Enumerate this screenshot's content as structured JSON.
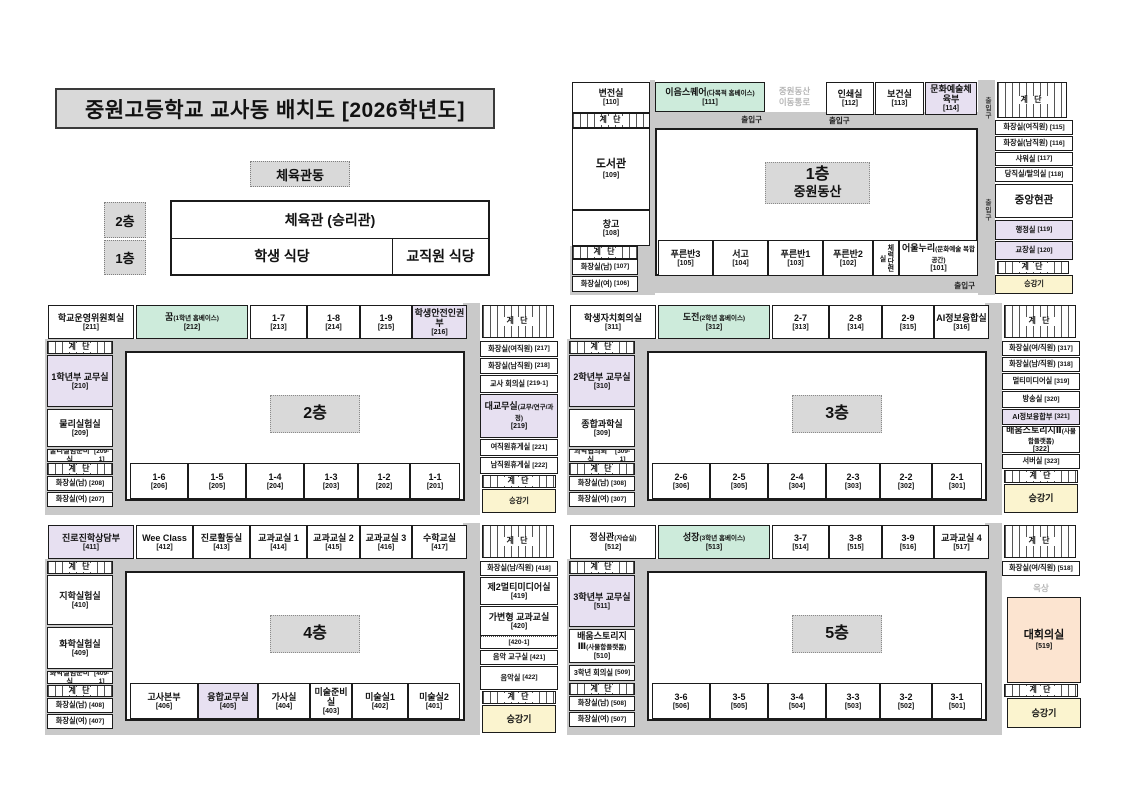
{
  "title": "중원고등학교 교사동 배치도 [2026학년도]",
  "colors": {
    "mint": "#cdebdb",
    "purple": "#e7e0f1",
    "peach": "#fce4d0",
    "elevator_yellow": "#fbf4cf",
    "corridor_gray": "#c9c9c9",
    "box_gray": "#d9d9d9"
  },
  "gym": {
    "building_label": "체육관동",
    "floor2_label": "2층",
    "floor1_label": "1층",
    "gym_name": "체육관 (승리관)",
    "student_cafeteria": "학생 식당",
    "staff_cafeteria": "교직원 식당"
  },
  "floors": {
    "f1": {
      "rooms": [
        {
          "id": "110",
          "label": "변전실",
          "num": "[110]"
        },
        {
          "id": "s1",
          "style": "stairs",
          "label": "계 단"
        },
        {
          "id": "109",
          "label": "도서관",
          "num": "[109]"
        },
        {
          "id": "108",
          "label": "창고",
          "num": "[108]"
        },
        {
          "id": "s2",
          "style": "stairs",
          "label": "계 단"
        },
        {
          "id": "107",
          "label": "화장실(남)",
          "num": "[107]"
        },
        {
          "id": "106",
          "label": "화장실(여)",
          "num": "[106]"
        },
        {
          "id": "111",
          "style": "mint",
          "label": "이음스퀘어",
          "sub": "(다목적 홈베이스)",
          "num": "[111]"
        },
        {
          "id": "exit1",
          "style": "cl",
          "label": "출입구",
          "align": "right"
        },
        {
          "id": "gtext",
          "style": "gtext",
          "label": "중원동산\n이동통로"
        },
        {
          "id": "112",
          "label": "인쇄실",
          "num": "[112]"
        },
        {
          "id": "113",
          "label": "보건실",
          "num": "[113]"
        },
        {
          "id": "114",
          "style": "purple",
          "label": "문화예술체육부",
          "num": "[114]"
        },
        {
          "id": "exit2",
          "style": "cl",
          "label": "출입구",
          "align": "left"
        },
        {
          "id": "s3",
          "style": "stairs",
          "label": "계 단"
        },
        {
          "id": "115",
          "label": "화장실(여직원)",
          "num": "[115]"
        },
        {
          "id": "116",
          "label": "화장실(남직원)",
          "num": "[116]"
        },
        {
          "id": "117",
          "label": "샤워실",
          "num": "[117]"
        },
        {
          "id": "118",
          "label": "당직실/탈의실",
          "num": "[118]"
        },
        {
          "id": "foyer",
          "label": "중앙현관"
        },
        {
          "id": "119",
          "style": "purple",
          "label": "행정실",
          "num": "[119]"
        },
        {
          "id": "120",
          "style": "purple",
          "label": "교장실",
          "num": "[120]"
        },
        {
          "id": "s4",
          "style": "stairs",
          "label": "계 단"
        },
        {
          "id": "lift",
          "style": "lift",
          "label": "승강기"
        },
        {
          "id": "vexit1",
          "style": "vcl",
          "label": "출입구"
        },
        {
          "id": "vexit2",
          "style": "vcl",
          "label": "출입구"
        },
        {
          "id": "center",
          "style": "center",
          "label": "1층",
          "sub": "중원동산"
        },
        {
          "id": "105",
          "label": "푸른반3",
          "num": "[105]"
        },
        {
          "id": "104",
          "label": "서고",
          "num": "[104]"
        },
        {
          "id": "103",
          "label": "푸른반1",
          "num": "[103]"
        },
        {
          "id": "102",
          "label": "푸른반2",
          "num": "[102]"
        },
        {
          "id": "fitness",
          "style": "vroom",
          "label": "체력단련실"
        },
        {
          "id": "101",
          "label": "어울누리",
          "sub": "(문화예술 복합공간)",
          "num": "[101]"
        },
        {
          "id": "exit3",
          "style": "cl",
          "label": "출입구",
          "align": "right"
        }
      ]
    },
    "f2": {
      "rooms": [
        {
          "id": "211",
          "label": "학교운영위원회실",
          "num": "[211]"
        },
        {
          "id": "212",
          "style": "mint",
          "label": "꿈",
          "sub": "(1학년 홈베이스)",
          "num": "[212]"
        },
        {
          "id": "213",
          "label": "1-7",
          "num": "[213]"
        },
        {
          "id": "214",
          "label": "1-8",
          "num": "[214]"
        },
        {
          "id": "215",
          "label": "1-9",
          "num": "[215]"
        },
        {
          "id": "216",
          "style": "purple",
          "label": "학생안전인권부",
          "num": "[216]"
        },
        {
          "id": "s1",
          "style": "stairs",
          "label": "계 단"
        },
        {
          "id": "217",
          "label": "화장실(여직원)",
          "num": "[217]"
        },
        {
          "id": "218",
          "label": "화장실(남직원)",
          "num": "[218]"
        },
        {
          "id": "219-1",
          "label": "교사 회의실",
          "num": "[219-1]"
        },
        {
          "id": "219",
          "style": "purple",
          "label": "대교무실",
          "sub": "(교무/연구/과정)",
          "num": "[219]"
        },
        {
          "id": "221",
          "label": "여직원휴게실",
          "num": "[221]"
        },
        {
          "id": "222",
          "label": "남직원휴게실",
          "num": "[222]"
        },
        {
          "id": "s2",
          "style": "stairs",
          "label": "계 단"
        },
        {
          "id": "lift",
          "style": "lift",
          "label": "승강기"
        },
        {
          "id": "s3",
          "style": "stairs",
          "label": "계 단"
        },
        {
          "id": "210",
          "style": "purple",
          "label": "1학년부 교무실",
          "num": "[210]"
        },
        {
          "id": "209",
          "label": "물리실험실",
          "num": "[209]"
        },
        {
          "id": "209-1",
          "label": "물리실험준비실",
          "num": "[209-1]"
        },
        {
          "id": "s4",
          "style": "stairs",
          "label": "계 단"
        },
        {
          "id": "208",
          "label": "화장실(남)",
          "num": "[208]"
        },
        {
          "id": "207",
          "label": "화장실(여)",
          "num": "[207]"
        },
        {
          "id": "center",
          "style": "center",
          "label": "2층"
        },
        {
          "id": "206",
          "label": "1-6",
          "num": "[206]"
        },
        {
          "id": "205",
          "label": "1-5",
          "num": "[205]"
        },
        {
          "id": "204",
          "label": "1-4",
          "num": "[204]"
        },
        {
          "id": "203",
          "label": "1-3",
          "num": "[203]"
        },
        {
          "id": "202",
          "label": "1-2",
          "num": "[202]"
        },
        {
          "id": "201",
          "label": "1-1",
          "num": "[201]"
        }
      ]
    },
    "f3": {
      "rooms": [
        {
          "id": "311",
          "label": "학생자치회의실",
          "num": "[311]"
        },
        {
          "id": "312",
          "style": "mint",
          "label": "도전",
          "sub": "(2학년 홈베이스)",
          "num": "[312]"
        },
        {
          "id": "313",
          "label": "2-7",
          "num": "[313]"
        },
        {
          "id": "314",
          "label": "2-8",
          "num": "[314]"
        },
        {
          "id": "315",
          "label": "2-9",
          "num": "[315]"
        },
        {
          "id": "316",
          "label": "AI정보융합실",
          "num": "[316]"
        },
        {
          "id": "s1",
          "style": "stairs",
          "label": "계 단"
        },
        {
          "id": "317",
          "label": "화장실(여/직원)",
          "num": "[317]"
        },
        {
          "id": "318",
          "label": "화장실(남/직원)",
          "num": "[318]"
        },
        {
          "id": "319",
          "label": "멀티미디어실",
          "num": "[319]"
        },
        {
          "id": "320",
          "label": "방송실",
          "num": "[320]"
        },
        {
          "id": "321",
          "style": "purple",
          "label": "AI정보융합부",
          "num": "[321]"
        },
        {
          "id": "322",
          "label": "배움스토리지Ⅱ",
          "sub": "(사물함플랫폼)",
          "num": "[322]"
        },
        {
          "id": "323",
          "label": "서버실",
          "num": "[323]"
        },
        {
          "id": "s2",
          "style": "stairs",
          "label": "계 단"
        },
        {
          "id": "lift",
          "style": "lift",
          "label": "승강기"
        },
        {
          "id": "s3",
          "style": "stairs",
          "label": "계 단"
        },
        {
          "id": "310",
          "style": "purple",
          "label": "2학년부 교무실",
          "num": "[310]"
        },
        {
          "id": "309",
          "label": "종합과학실",
          "num": "[309]"
        },
        {
          "id": "309-1",
          "label": "과학협의회실",
          "num": "[309-1]"
        },
        {
          "id": "s4",
          "style": "stairs",
          "label": "계 단"
        },
        {
          "id": "308",
          "label": "화장실(남)",
          "num": "[308]"
        },
        {
          "id": "307",
          "label": "화장실(여)",
          "num": "[307]"
        },
        {
          "id": "center",
          "style": "center",
          "label": "3층"
        },
        {
          "id": "306",
          "label": "2-6",
          "num": "[306]"
        },
        {
          "id": "305",
          "label": "2-5",
          "num": "[305]"
        },
        {
          "id": "304",
          "label": "2-4",
          "num": "[304]"
        },
        {
          "id": "303",
          "label": "2-3",
          "num": "[303]"
        },
        {
          "id": "302",
          "label": "2-2",
          "num": "[302]"
        },
        {
          "id": "301",
          "label": "2-1",
          "num": "[301]"
        }
      ]
    },
    "f4": {
      "rooms": [
        {
          "id": "411",
          "style": "purple",
          "label": "진로진학상담부",
          "num": "[411]"
        },
        {
          "id": "412",
          "label": "Wee Class",
          "num": "[412]"
        },
        {
          "id": "413",
          "label": "진로활동실",
          "num": "[413]"
        },
        {
          "id": "414",
          "label": "교과교실 1",
          "num": "[414]"
        },
        {
          "id": "415",
          "label": "교과교실 2",
          "num": "[415]"
        },
        {
          "id": "416",
          "label": "교과교실 3",
          "num": "[416]"
        },
        {
          "id": "417",
          "label": "수학교실",
          "num": "[417]"
        },
        {
          "id": "s1",
          "style": "stairs",
          "label": "계 단"
        },
        {
          "id": "418",
          "label": "화장실(남/직원)",
          "num": "[418]"
        },
        {
          "id": "419",
          "label": "제2멀티미디어실",
          "num": "[419]"
        },
        {
          "id": "420",
          "label": "가변형 교과교실",
          "num": "[420]"
        },
        {
          "id": "420-1",
          "label": "",
          "num": "[420-1]"
        },
        {
          "id": "421",
          "label": "음악 교구실",
          "num": "[421]"
        },
        {
          "id": "422",
          "label": "음악실",
          "num": "[422]"
        },
        {
          "id": "s2",
          "style": "stairs",
          "label": "계 단"
        },
        {
          "id": "lift",
          "style": "lift",
          "label": "승강기"
        },
        {
          "id": "s3",
          "style": "stairs",
          "label": "계 단"
        },
        {
          "id": "410",
          "label": "지학실험실",
          "num": "[410]"
        },
        {
          "id": "409",
          "label": "화학실험실",
          "num": "[409]"
        },
        {
          "id": "409-1",
          "label": "화학실험준비실",
          "num": "[409-1]"
        },
        {
          "id": "s4",
          "style": "stairs",
          "label": "계 단"
        },
        {
          "id": "408",
          "label": "화장실(남)",
          "num": "[408]"
        },
        {
          "id": "407",
          "label": "화장실(여)",
          "num": "[407]"
        },
        {
          "id": "center",
          "style": "center",
          "label": "4층"
        },
        {
          "id": "406",
          "label": "고사본부",
          "num": "[406]"
        },
        {
          "id": "405",
          "style": "purple",
          "label": "융합교무실",
          "num": "[405]"
        },
        {
          "id": "404",
          "label": "가사실",
          "num": "[404]"
        },
        {
          "id": "403",
          "label": "미술준비실",
          "num": "[403]"
        },
        {
          "id": "402",
          "label": "미술실1",
          "num": "[402]"
        },
        {
          "id": "401",
          "label": "미술실2",
          "num": "[401]"
        }
      ]
    },
    "f5": {
      "rooms": [
        {
          "id": "512",
          "label": "정심관",
          "sub": "(자습실)",
          "num": "[512]"
        },
        {
          "id": "513",
          "style": "mint",
          "label": "성장",
          "sub": "(3학년 홈베이스)",
          "num": "[513]"
        },
        {
          "id": "514",
          "label": "3-7",
          "num": "[514]"
        },
        {
          "id": "515",
          "label": "3-8",
          "num": "[515]"
        },
        {
          "id": "516",
          "label": "3-9",
          "num": "[516]"
        },
        {
          "id": "517",
          "label": "교과교실 4",
          "num": "[517]"
        },
        {
          "id": "s1",
          "style": "stairs",
          "label": "계 단"
        },
        {
          "id": "518",
          "label": "화장실(여/직원)",
          "num": "[518]"
        },
        {
          "id": "roof",
          "style": "gtext",
          "label": "옥상"
        },
        {
          "id": "519",
          "style": "peach",
          "label": "대회의실",
          "num": "[519]"
        },
        {
          "id": "s2",
          "style": "stairs",
          "label": "계 단"
        },
        {
          "id": "lift",
          "style": "lift",
          "label": "승강기"
        },
        {
          "id": "s3",
          "style": "stairs",
          "label": "계 단"
        },
        {
          "id": "511",
          "style": "purple",
          "label": "3학년부 교무실",
          "num": "[511]"
        },
        {
          "id": "510",
          "label": "배움스토리지Ⅲ",
          "sub": "(사물함플랫폼)",
          "num": "[510]"
        },
        {
          "id": "509",
          "label": "3학년 회의실",
          "num": "[509]"
        },
        {
          "id": "s4",
          "style": "stairs",
          "label": "계 단"
        },
        {
          "id": "508",
          "label": "화장실(남)",
          "num": "[508]"
        },
        {
          "id": "507",
          "label": "화장실(여)",
          "num": "[507]"
        },
        {
          "id": "center",
          "style": "center",
          "label": "5층"
        },
        {
          "id": "506",
          "label": "3-6",
          "num": "[506]"
        },
        {
          "id": "505",
          "label": "3-5",
          "num": "[505]"
        },
        {
          "id": "504",
          "label": "3-4",
          "num": "[504]"
        },
        {
          "id": "503",
          "label": "3-3",
          "num": "[503]"
        },
        {
          "id": "502",
          "label": "3-2",
          "num": "[502]"
        },
        {
          "id": "501",
          "label": "3-1",
          "num": "[501]"
        }
      ]
    }
  }
}
